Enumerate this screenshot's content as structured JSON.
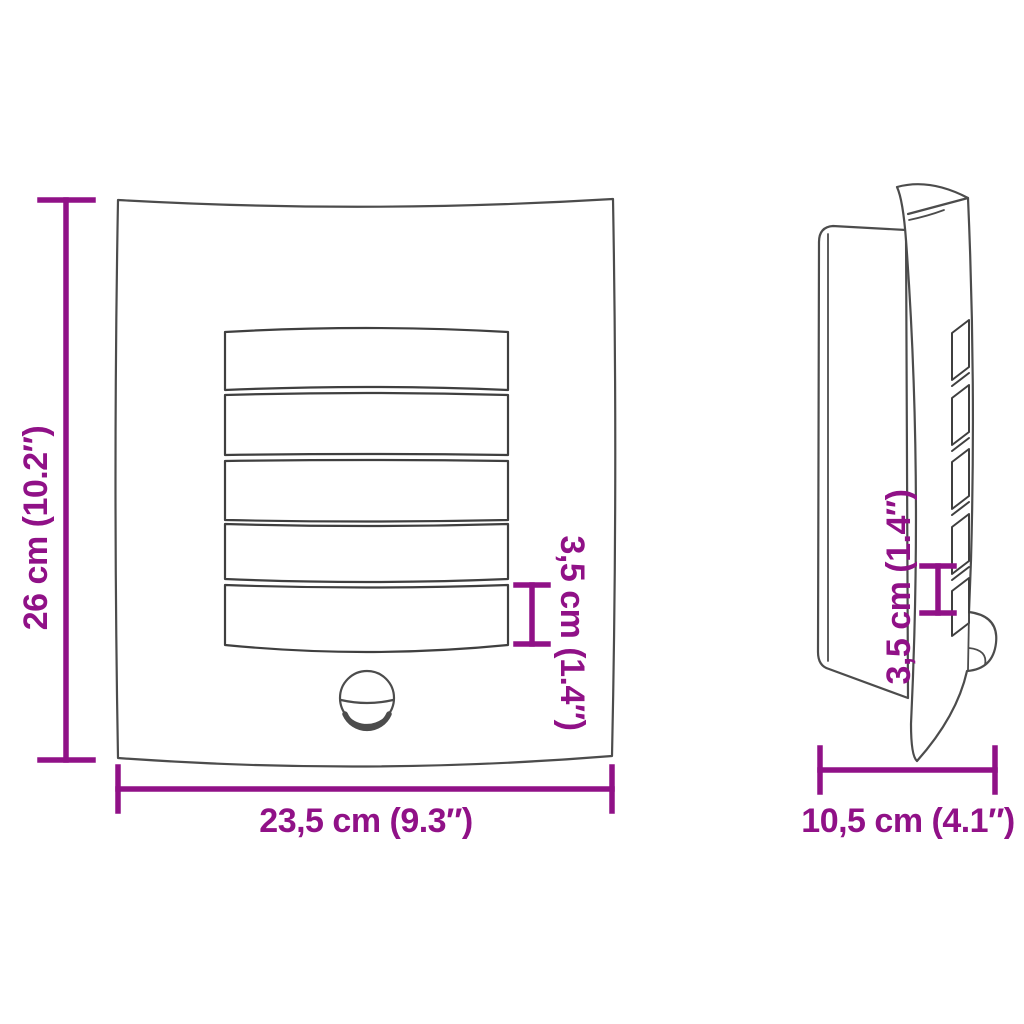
{
  "diagram": {
    "description": "Outdoor wall light with motion sensor - dimension drawing with front and side views",
    "colors": {
      "accent": "#901187",
      "outline": "#4c4c4c",
      "background": "#ffffff"
    },
    "front_view": {
      "louver_count": 5,
      "height_label": "26 cm (10.2″)",
      "width_label": "23,5 cm (9.3″)",
      "louver_label": "3,5 cm (1.4″)"
    },
    "side_view": {
      "louver_count": 5,
      "depth_label": "10,5 cm (4.1″)",
      "louver_label": "3,5 cm (1.4″)"
    }
  }
}
